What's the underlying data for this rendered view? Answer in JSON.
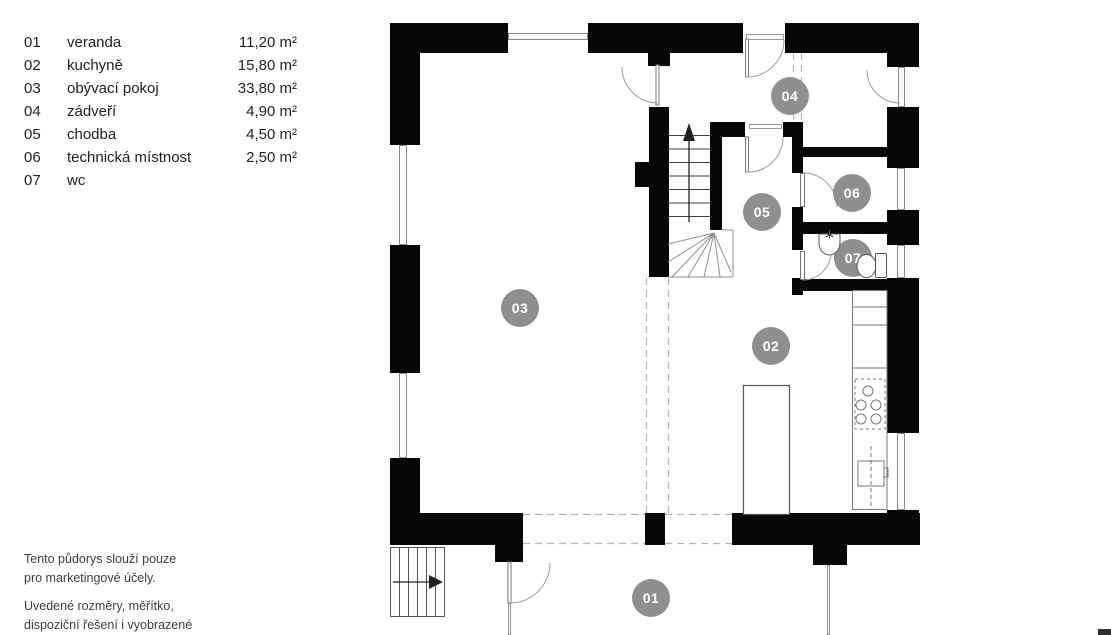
{
  "legend": {
    "rooms": [
      {
        "num": "01",
        "name": "veranda",
        "area": "11,20 m²"
      },
      {
        "num": "02",
        "name": "kuchyně",
        "area": "15,80 m²"
      },
      {
        "num": "03",
        "name": "obývací pokoj",
        "area": "33,80 m²"
      },
      {
        "num": "04",
        "name": "zádveří",
        "area": "4,90 m²"
      },
      {
        "num": "05",
        "name": "chodba",
        "area": "4,50 m²"
      },
      {
        "num": "06",
        "name": "technická místnost",
        "area": "2,50 m²"
      },
      {
        "num": "07",
        "name": "wc",
        "area": ""
      }
    ]
  },
  "footer": {
    "para1": [
      "Tento půdorys slouží pouze",
      "pro marketingové účely."
    ],
    "para2": [
      "Uvedené rozměry, měřítko,",
      "dispoziční řešení i vyobrazené",
      "zařízení jsou pouze ilustrativní."
    ]
  },
  "plan": {
    "labels": {
      "r01": "01",
      "r02": "02",
      "r03": "03",
      "r04": "04",
      "r05": "05",
      "r06": "06",
      "r07": "07"
    }
  },
  "colors": {
    "wall": "#070707",
    "room_label_bg": "#8f8f8f",
    "window_line": "#8a8a8a",
    "dashed_line": "#b3b3b3",
    "fixture_line": "#555555"
  }
}
